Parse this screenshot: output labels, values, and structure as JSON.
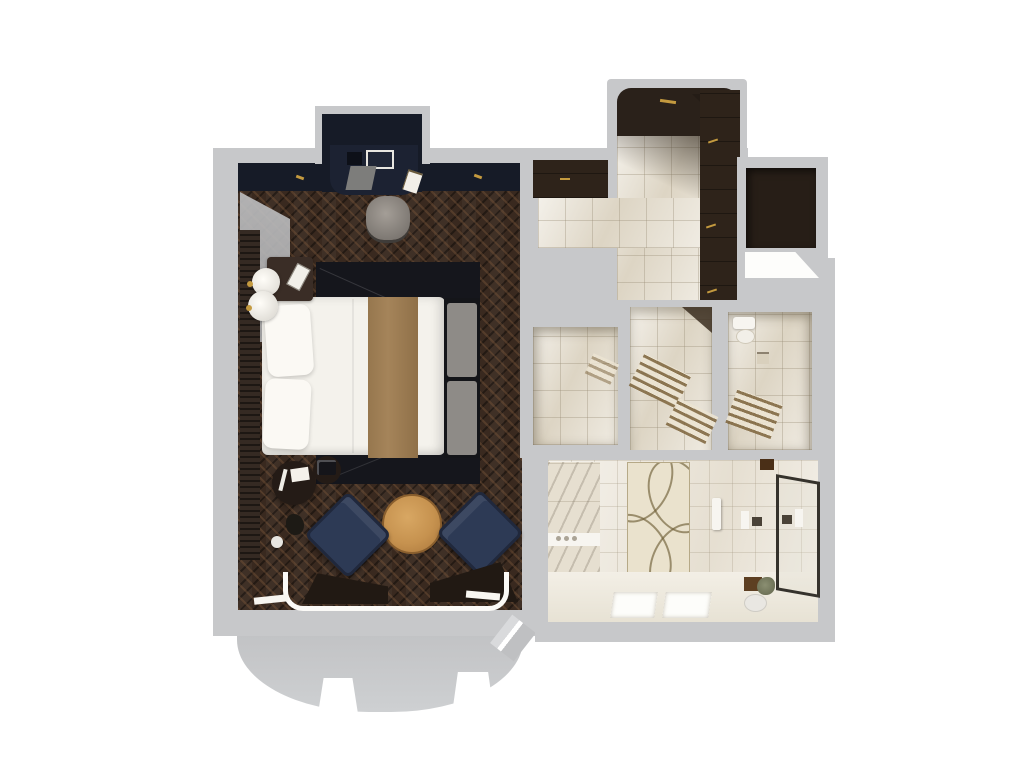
{
  "meta": {
    "title": "Hotel suite 3D floor plan, top-down dollhouse view",
    "view": "top-down 3D render",
    "background": "white"
  },
  "colors": {
    "wall": "#c7c8ca",
    "wallShade": "#b2b3b5",
    "navy": "#161b27",
    "floor": "#39291f",
    "marble": "#e6dfd0",
    "bathFloor": "#ece6da",
    "closet": "#2e231a",
    "chairNavy": "#2d3a55",
    "tableWood": "#c6924f",
    "runner": "#a5845a",
    "bedBase": "#15161c",
    "linen": "#f4f2ec",
    "gold": "#c49a3f",
    "glass": "#35322c",
    "rugLine": "#6e5f38"
  },
  "rooms": {
    "bedroom": {
      "label": "Bedroom with dark herringbone wood floor",
      "furniture": [
        "double bed with white linens and tan runner",
        "upholstered bench at foot of bed",
        "nightstand with lamp and telephone",
        "round side tables with documents and phone",
        "two navy lounge chairs",
        "round wood coffee table",
        "desk alcove with chair",
        "curved bay window with curtains"
      ]
    },
    "entry": {
      "label": "Entry foyer with dark wood walls and door"
    },
    "dressing": {
      "label": "Dressing corridor with marble tile and built-in wardrobes"
    },
    "niche": {
      "label": "Dark storage niche"
    },
    "shower_room": {
      "label": "Marble shower compartment"
    },
    "sauna_room": {
      "label": "Marble compartment with slatted benches"
    },
    "wc_room": {
      "label": "WC compartment with toilet and towel ladder"
    },
    "bathroom": {
      "label": "Master bathroom",
      "furniture": [
        "patterned ellipse rug",
        "double vanity with two sinks",
        "bathtub deck with three controls",
        "walk-in shower with glass panel",
        "stool",
        "plant",
        "bath mat"
      ]
    }
  }
}
